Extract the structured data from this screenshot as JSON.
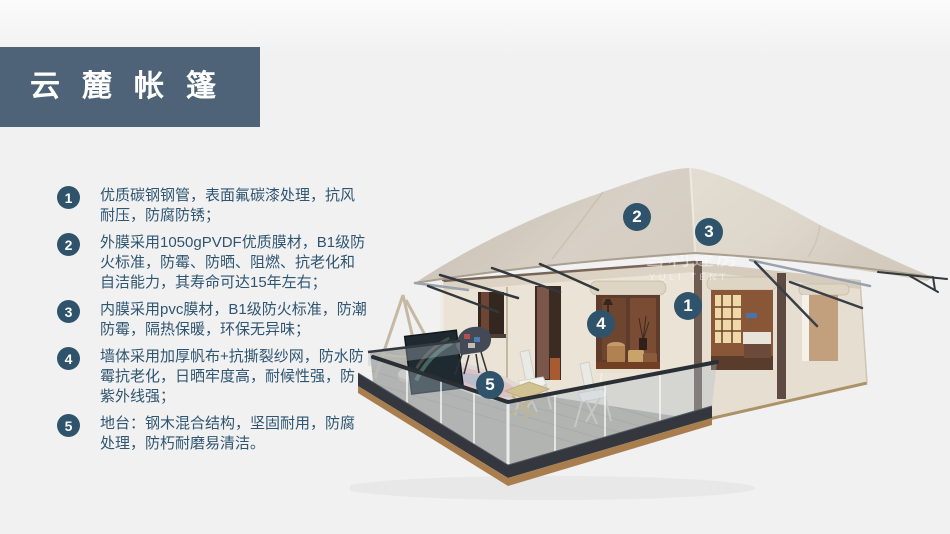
{
  "header": {
    "title": "云麓帐篷"
  },
  "features": {
    "items": [
      {
        "number": "1",
        "text": "优质碳钢钢管，表面氟碳漆处理，抗风耐压，防腐防锈；"
      },
      {
        "number": "2",
        "text": "外膜采用1050gPVDF优质膜材，B1级防火标准，防霉、防晒、阻燃、抗老化和自洁能力，其寿命可达15年左右；"
      },
      {
        "number": "3",
        "text": "内膜采用pvc膜材，B1级防火标准，防潮防霉，隔热保暖，环保无异味；"
      },
      {
        "number": "4",
        "text": "墙体采用加厚帆布+抗撕裂纱网，防水防霉抗老化，日晒牢度高，耐候性强，防紫外线强；"
      },
      {
        "number": "5",
        "text": "地台：钢木混合结构，坚固耐用，防腐处理，防朽耐磨易清洁。"
      }
    ]
  },
  "illustration": {
    "markers": [
      {
        "label": "1"
      },
      {
        "label": "2"
      },
      {
        "label": "3"
      },
      {
        "label": "4"
      },
      {
        "label": "5"
      }
    ],
    "watermark": {
      "line1": "雪利篷房",
      "line2": "YULI TENT"
    }
  },
  "colors": {
    "header_bg": "#4e6377",
    "badge": "#2e536b",
    "body_text": "#2f5570",
    "background": "#f1f1f2",
    "roof": "#ddd6cb",
    "wall": "#ebe4d6"
  }
}
